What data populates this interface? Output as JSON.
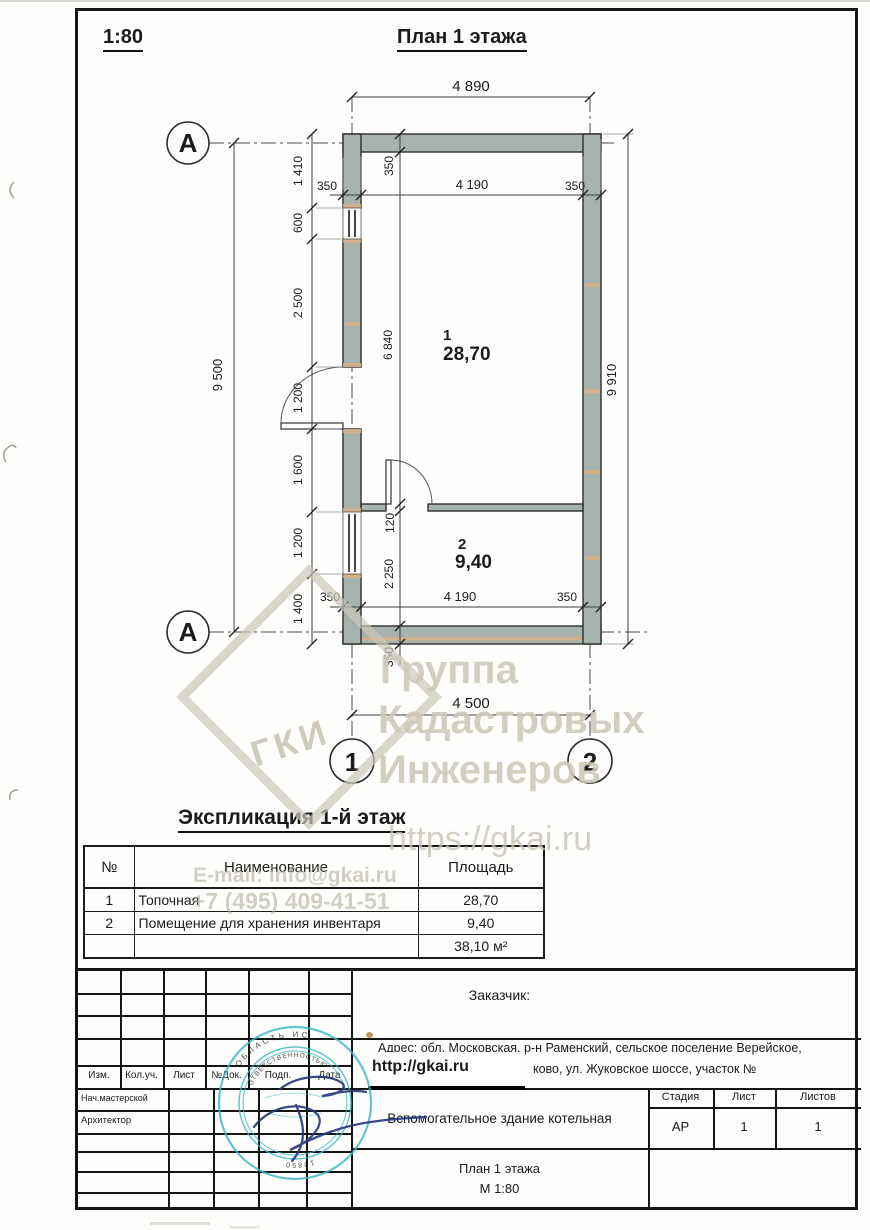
{
  "header": {
    "scale": "1:80",
    "title": "План 1 этажа"
  },
  "plan": {
    "axes": {
      "row_top": "А",
      "row_bottom": "А",
      "col_left": "1",
      "col_right": "2"
    },
    "rooms": [
      {
        "num": "1",
        "area": "28,70"
      },
      {
        "num": "2",
        "area": "9,40"
      }
    ],
    "dims": {
      "top_overall": "4 890",
      "top_chain": [
        "350",
        "4 190",
        "350"
      ],
      "top_wall": "350",
      "left_chain": [
        "1 410",
        "600",
        "2 500",
        "1 200",
        "1 600",
        "1 200",
        "1 400"
      ],
      "left_overall": "9 500",
      "right_overall": "9 910",
      "room1_height": "6 840",
      "partition": "120",
      "room2_height": "2 250",
      "bottom_wall": "350",
      "bottom_chain": [
        "350",
        "4 190",
        "350"
      ],
      "bottom_overall": "4 500"
    }
  },
  "explication": {
    "heading": "Экспликация 1-й этаж",
    "columns": [
      "№",
      "Наименование",
      "Площадь"
    ],
    "rows": [
      [
        "1",
        "Топочная",
        "28,70"
      ],
      [
        "2",
        "Помещение для хранения инвентаря",
        "9,40"
      ],
      [
        "",
        "",
        "38,10 м²"
      ]
    ]
  },
  "watermark": {
    "diamond_label": "ГКИ",
    "line1": "Группа",
    "line2": "Кадастровых",
    "line3": "Инженеров",
    "url": "https://gkai.ru",
    "email": "E-mail: info@gkai.ru",
    "phone": "+7 (495) 409-41-51"
  },
  "titleblock": {
    "customer_label": "Заказчик:",
    "address_line1": "Адрес: обл. Московская, р-н Раменский, сельское поселение Верейское,",
    "address_line2": "ково, ул. Жуковское шоссе, участок №",
    "site_link": "http://gkai.ru",
    "bottom_labels": [
      "Изм.",
      "Кол.уч.",
      "Лист",
      "№Док.",
      "Подп.",
      "Дата"
    ],
    "roles": [
      "Нач.мастерской",
      "Архитектор"
    ],
    "project_name": "Вспомогательное здание котельная",
    "sheet_name": "План 1 этажа",
    "sheet_scale": "М 1:80",
    "stage_label": "Стадия",
    "sheet_label": "Лист",
    "sheets_label": "Листов",
    "stage": "АР",
    "sheet": "1",
    "sheets": "1"
  },
  "stamp": {
    "ring_text_top": "ОБЛАСТЬ ИС",
    "ring_text_inner": "ОТВЕТСТВЕННОСТЬЮ",
    "ring_digits": "10850"
  },
  "colors": {
    "wall": "#a9b3ae",
    "tan": "#d6b088",
    "stamp": "#3db6c5",
    "watermark": "#d0cbbc",
    "signature": "#26357d"
  }
}
